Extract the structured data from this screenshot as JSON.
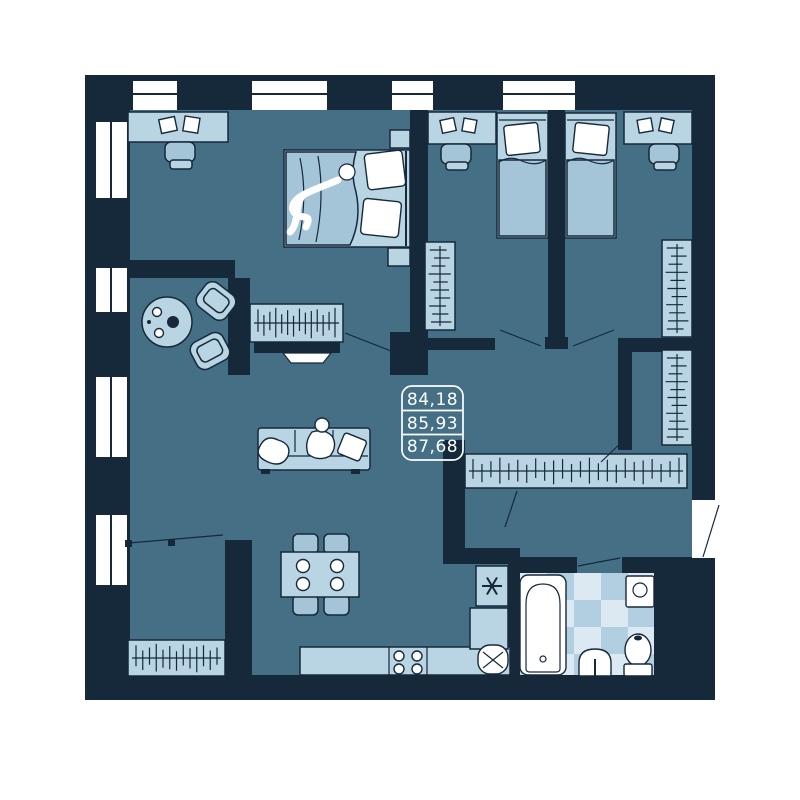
{
  "page": {
    "background": "#ffffff"
  },
  "area_label": {
    "values": [
      "84,18",
      "85,93",
      "87,68"
    ]
  },
  "palette": {
    "page_background": "#ffffff",
    "wall": "#16293b",
    "floor": "#446f85",
    "furn_light": "#b9d4e2",
    "furn_mid": "#a4c4d8",
    "tile_light": "#dce9f3",
    "tile_mid": "#b2cfe1",
    "accent_white": "#ffffff"
  },
  "symbols": [
    "double-bed",
    "single-bed",
    "desk",
    "office-chair",
    "wardrobe-hanging-rail",
    "tv",
    "sofa",
    "armchair",
    "coffee-table",
    "dining-table",
    "kitchen-counter",
    "stove-burners",
    "kitchen-sink",
    "fridge-snowflake",
    "bathtub",
    "washing-machine",
    "wash-basin",
    "toilet",
    "window",
    "door-swing"
  ]
}
